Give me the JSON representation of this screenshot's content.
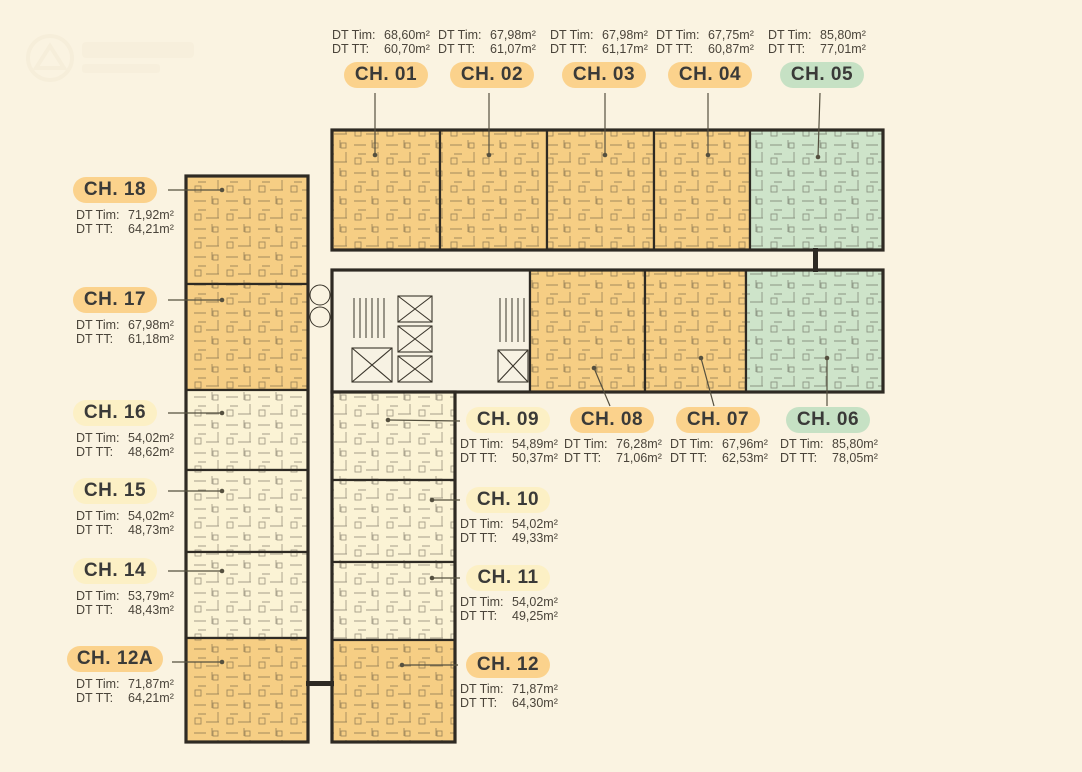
{
  "palette": {
    "background": "#FAF3E1",
    "unit_orange": "#F6CE84",
    "unit_pale": "#FBF3D5",
    "unit_green": "#CEE4CA",
    "core_fill": "#F7F2E3",
    "wall": "#2E2A23",
    "badge_orange": "#FBD28C",
    "badge_pale": "#FCF0C5",
    "badge_green": "#C6E1C4",
    "badge_text": "#3A3A38",
    "area_text": "#4A443A",
    "leader": "#55503F"
  },
  "labels": {
    "tim": "DT Tim:",
    "tt": "DT TT:"
  },
  "units": [
    {
      "id": "CH. 01",
      "tim": "68,60m²",
      "tt": "60,70m²",
      "status_color": "orange"
    },
    {
      "id": "CH. 02",
      "tim": "67,98m²",
      "tt": "61,07m²",
      "status_color": "orange"
    },
    {
      "id": "CH. 03",
      "tim": "67,98m²",
      "tt": "61,17m²",
      "status_color": "orange"
    },
    {
      "id": "CH. 04",
      "tim": "67,75m²",
      "tt": "60,87m²",
      "status_color": "orange"
    },
    {
      "id": "CH. 05",
      "tim": "85,80m²",
      "tt": "77,01m²",
      "status_color": "green"
    },
    {
      "id": "CH. 06",
      "tim": "85,80m²",
      "tt": "78,05m²",
      "status_color": "green"
    },
    {
      "id": "CH. 07",
      "tim": "67,96m²",
      "tt": "62,53m²",
      "status_color": "orange"
    },
    {
      "id": "CH. 08",
      "tim": "76,28m²",
      "tt": "71,06m²",
      "status_color": "orange"
    },
    {
      "id": "CH. 09",
      "tim": "54,89m²",
      "tt": "50,37m²",
      "status_color": "pale"
    },
    {
      "id": "CH. 10",
      "tim": "54,02m²",
      "tt": "49,33m²",
      "status_color": "pale"
    },
    {
      "id": "CH. 11",
      "tim": "54,02m²",
      "tt": "49,25m²",
      "status_color": "pale"
    },
    {
      "id": "CH. 12",
      "tim": "71,87m²",
      "tt": "64,30m²",
      "status_color": "orange"
    },
    {
      "id": "CH. 12A",
      "tim": "71,87m²",
      "tt": "64,21m²",
      "status_color": "orange"
    },
    {
      "id": "CH. 14",
      "tim": "53,79m²",
      "tt": "48,43m²",
      "status_color": "pale"
    },
    {
      "id": "CH. 15",
      "tim": "54,02m²",
      "tt": "48,73m²",
      "status_color": "pale"
    },
    {
      "id": "CH. 16",
      "tim": "54,02m²",
      "tt": "48,62m²",
      "status_color": "pale"
    },
    {
      "id": "CH. 17",
      "tim": "67,98m²",
      "tt": "61,18m²",
      "status_color": "orange"
    },
    {
      "id": "CH. 18",
      "tim": "71,92m²",
      "tt": "64,21m²",
      "status_color": "orange"
    }
  ]
}
